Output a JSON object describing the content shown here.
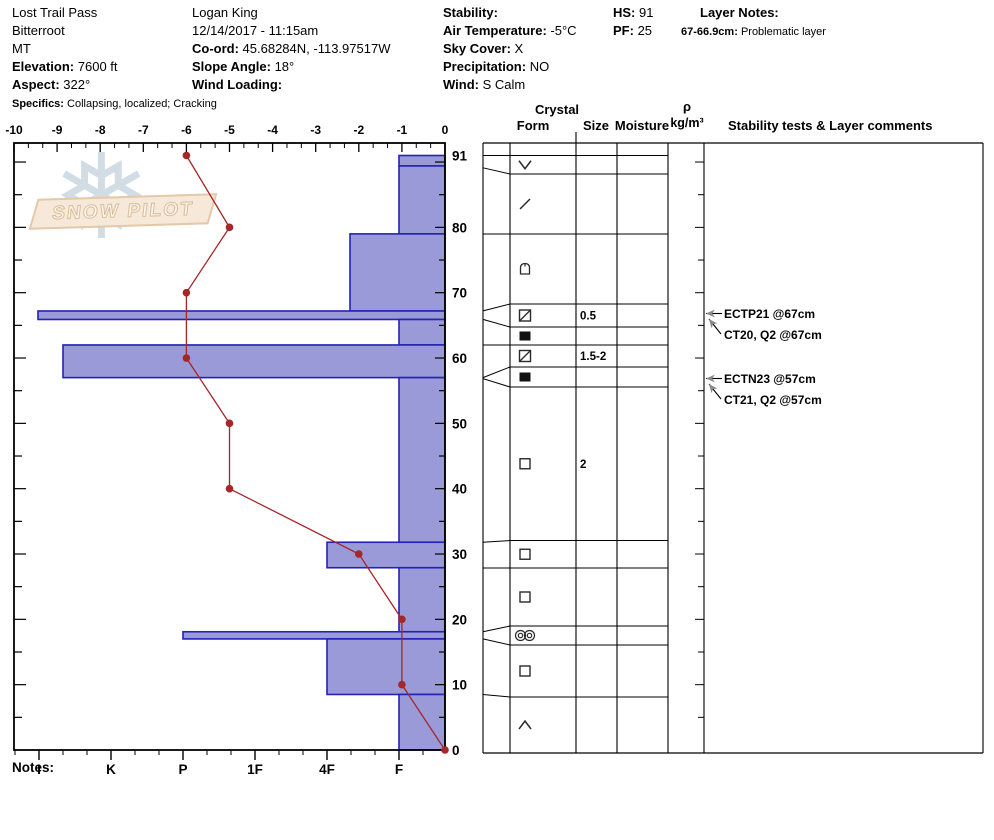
{
  "colors": {
    "bar_fill": "#9b9ad8",
    "bar_border": "#2323b4",
    "temp_line": "#a52727",
    "frame": "#000000",
    "arrow_gray": "#8a8a8a",
    "watermark_flake": "#c9d7e1",
    "banner_bg": "#f7e9da",
    "banner_border": "#e4c8a8"
  },
  "watermark": {
    "text": "SNOW PILOT",
    "flake_glyph": "❅"
  },
  "notes_label": "Notes:",
  "header": {
    "columns": [
      {
        "x": 12,
        "lines": [
          {
            "label": "",
            "value": "Lost Trail Pass"
          },
          {
            "label": "",
            "value": "Bitterroot"
          },
          {
            "label": "",
            "value": "MT"
          },
          {
            "label": "Elevation:",
            "value": "7600 ft"
          },
          {
            "label": "Aspect:",
            "value": "322°"
          },
          {
            "label": "Specifics:",
            "value": "Collapsing, localized;  Cracking",
            "small": true
          }
        ]
      },
      {
        "x": 192,
        "lines": [
          {
            "label": "",
            "value": "Logan King"
          },
          {
            "label": "",
            "value": "12/14/2017 - 11:15am"
          },
          {
            "label": "Co-ord:",
            "value": "45.68284N, -113.97517W"
          },
          {
            "label": "Slope Angle:",
            "value": "18°"
          },
          {
            "label": "Wind Loading:",
            "value": ""
          }
        ]
      },
      {
        "x": 443,
        "lines": [
          {
            "label": "Stability:",
            "value": ""
          },
          {
            "label": "Air Temperature:",
            "value": "-5°C"
          },
          {
            "label": "Sky Cover:",
            "value": "X"
          },
          {
            "label": "Precipitation:",
            "value": "NO"
          },
          {
            "label": "Wind:",
            "value": "S Calm"
          }
        ]
      },
      {
        "x": 613,
        "lines": [
          {
            "label": "HS:",
            "value": "91"
          },
          {
            "label": "PF:",
            "value": "25"
          }
        ]
      },
      {
        "x": 681,
        "lines": [
          {
            "label": "Layer Notes:",
            "value": "",
            "indent": 19
          },
          {
            "label": "67-66.9cm:",
            "value": "Problematic layer",
            "small": true
          }
        ]
      }
    ]
  },
  "chart_data": {
    "type": "snow-profile",
    "title": "Snow pit profile - hardness bars with temperature overlay",
    "temperature_axis": {
      "unit": "°C",
      "ticks": [
        -10,
        -9,
        -8,
        -7,
        -6,
        -5,
        -4,
        -3,
        -2,
        -1,
        0
      ],
      "range": [
        -10,
        0
      ],
      "position": "top"
    },
    "hardness_axis": {
      "labels": [
        "I",
        "K",
        "P",
        "1F",
        "4F",
        "F"
      ],
      "position": "bottom",
      "direction": "hard-left-to-soft-right"
    },
    "depth_axis": {
      "unit": "cm",
      "labels": [
        91,
        80,
        70,
        60,
        50,
        40,
        30,
        20,
        10,
        0
      ],
      "total_depth_cm": 91,
      "position": "right"
    },
    "temperature_profile": [
      {
        "depth_cm": 91,
        "temp_c": -6
      },
      {
        "depth_cm": 80,
        "temp_c": -5
      },
      {
        "depth_cm": 70,
        "temp_c": -6
      },
      {
        "depth_cm": 60,
        "temp_c": -6
      },
      {
        "depth_cm": 50,
        "temp_c": -5
      },
      {
        "depth_cm": 40,
        "temp_c": -5
      },
      {
        "depth_cm": 30,
        "temp_c": -2
      },
      {
        "depth_cm": 20,
        "temp_c": -1
      },
      {
        "depth_cm": 10,
        "temp_c": -1
      },
      {
        "depth_cm": 0,
        "temp_c": 0
      }
    ],
    "layers": [
      {
        "top_cm": 91,
        "bottom_cm": 89.4,
        "hardness": "F"
      },
      {
        "top_cm": 89.4,
        "bottom_cm": 79,
        "hardness": "F"
      },
      {
        "top_cm": 79,
        "bottom_cm": 67.2,
        "hardness": "4F+"
      },
      {
        "top_cm": 67.2,
        "bottom_cm": 65.9,
        "hardness": "I"
      },
      {
        "top_cm": 65.9,
        "bottom_cm": 62,
        "hardness": "F"
      },
      {
        "top_cm": 62,
        "bottom_cm": 57,
        "hardness": "K+"
      },
      {
        "top_cm": 57,
        "bottom_cm": 31.8,
        "hardness": "F"
      },
      {
        "top_cm": 31.8,
        "bottom_cm": 27.9,
        "hardness": "4F"
      },
      {
        "top_cm": 27.9,
        "bottom_cm": 18.1,
        "hardness": "F"
      },
      {
        "top_cm": 18.1,
        "bottom_cm": 17,
        "hardness": "P"
      },
      {
        "top_cm": 17,
        "bottom_cm": 8.5,
        "hardness": "4F"
      },
      {
        "top_cm": 8.5,
        "bottom_cm": 0,
        "hardness": "F"
      }
    ],
    "grain_table": {
      "headers": {
        "crystal": "Crystal",
        "form": "Form",
        "size": "Size",
        "moisture": "Moisture",
        "density_rho": "ρ",
        "density_unit": "kg/m³",
        "comments": "Stability tests & Layer comments"
      },
      "rows": [
        {
          "form": "",
          "size": "",
          "moisture": ""
        },
        {
          "form": "surface-hoar",
          "size": "",
          "moisture": ""
        },
        {
          "form": "decomposing",
          "size": "",
          "moisture": ""
        },
        {
          "form": "dome",
          "size": "",
          "moisture": ""
        },
        {
          "form": "square-diagonal",
          "size": "0.5",
          "moisture": ""
        },
        {
          "form": "filled-square",
          "size": "",
          "moisture": ""
        },
        {
          "form": "square-diagonal",
          "size": "1.5-2",
          "moisture": ""
        },
        {
          "form": "filled-square",
          "size": "",
          "moisture": ""
        },
        {
          "form": "open-square",
          "size": "2",
          "moisture": ""
        },
        {
          "form": "open-square",
          "size": "",
          "moisture": ""
        },
        {
          "form": "open-square",
          "size": "",
          "moisture": ""
        },
        {
          "form": "double-circles",
          "size": "",
          "moisture": ""
        },
        {
          "form": "open-square",
          "size": "",
          "moisture": ""
        },
        {
          "form": "chevron-up",
          "size": "",
          "moisture": ""
        }
      ]
    },
    "stability_tests": [
      {
        "label": "ECTP21 @67cm",
        "depth_cm": 67,
        "arrow": "horizontal"
      },
      {
        "label": "CT20, Q2 @67cm",
        "depth_cm": 67,
        "arrow": "diagonal"
      },
      {
        "label": "ECTN23 @57cm",
        "depth_cm": 57,
        "arrow": "horizontal"
      },
      {
        "label": "CT21, Q2 @57cm",
        "depth_cm": 57,
        "arrow": "diagonal"
      }
    ]
  }
}
